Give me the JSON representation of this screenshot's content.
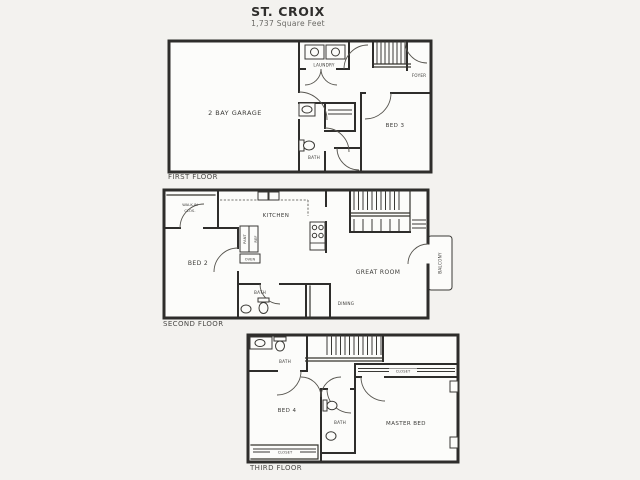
{
  "title": "ST. CROIX",
  "subtitle": "1,737 Square Feet",
  "colors": {
    "ink": "#2e2d2b",
    "paper": "#f3f2ef",
    "plan_fill": "#fcfcfa",
    "label_text": "#3c3b38"
  },
  "floor_first": {
    "caption": "FIRST FLOOR",
    "labels": {
      "garage": "2 BAY GARAGE",
      "laundry": "LAUNDRY",
      "foyer": "FOYER",
      "bed3": "BED 3",
      "bath": "BATH"
    }
  },
  "floor_second": {
    "caption": "SECOND FLOOR",
    "labels": {
      "walkin_1": "WALK-IN",
      "walkin_2": "CLOS.",
      "bed2": "BED 2",
      "kitchen": "KITCHEN",
      "pantry": "PANT",
      "ref": "REF",
      "oven": "OVEN",
      "great_room": "GREAT ROOM",
      "dining": "DINING",
      "bath": "BATH",
      "balcony": "BALCONY"
    }
  },
  "floor_third": {
    "caption": "THIRD FLOOR",
    "labels": {
      "bath_top": "BATH",
      "bed4": "BED 4",
      "bath_mid": "BATH",
      "master": "MASTER BED",
      "closet_top": "CLOSET",
      "closet_bottom": "CLOSET"
    }
  }
}
